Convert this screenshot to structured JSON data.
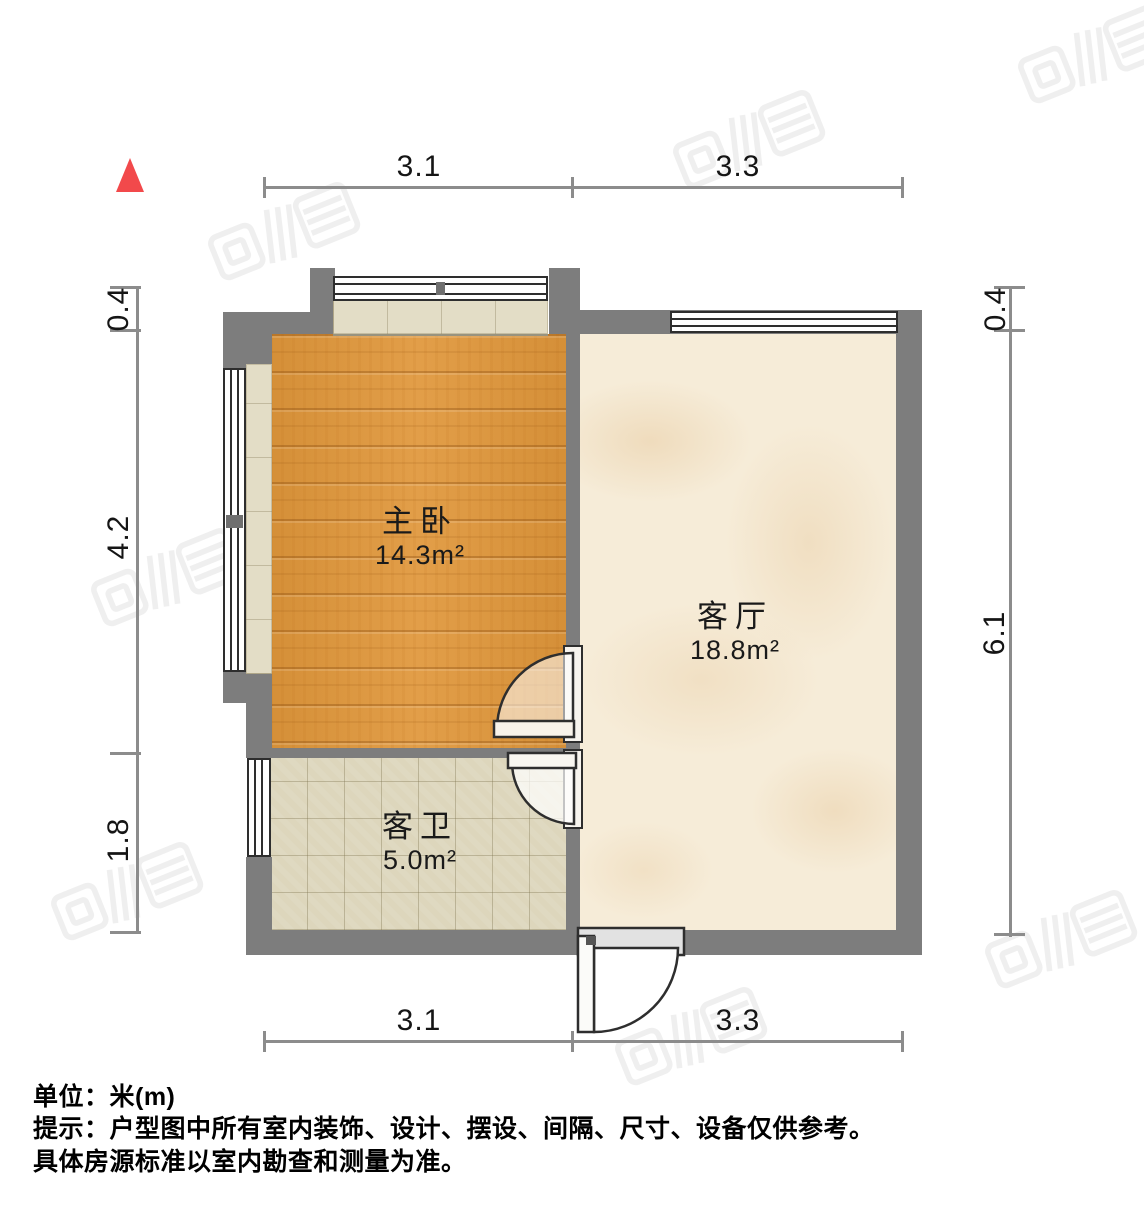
{
  "rooms": [
    {
      "name": "主卧",
      "area": "14.3m²"
    },
    {
      "name": "客厅",
      "area": "18.8m²"
    },
    {
      "name": "客卫",
      "area": "5.0m²"
    }
  ],
  "dimensions": {
    "top": [
      "3.1",
      "3.3"
    ],
    "bottom": [
      "3.1",
      "3.3"
    ],
    "left": [
      "0.4",
      "4.2",
      "1.8"
    ],
    "right": [
      "0.4",
      "6.1"
    ]
  },
  "footer": {
    "unit": "单位：米(m)",
    "note1": "提示：户型图中所有室内装饰、设计、摆设、间隔、尺寸、设备仅供参考。",
    "note2": "具体房源标准以室内勘查和测量为准。"
  },
  "colors": {
    "wall": "#7d7d7d",
    "dim": "#8c8c8c",
    "text": "#151515",
    "north": "#f2494b",
    "wood": "#e0973b",
    "marble": "#f6ecd8",
    "tile": "#ddd6bc",
    "sill": "#e3ddc6",
    "stroke": "#2e2e2e"
  },
  "watermarks": {
    "icon": "watermark-logo",
    "positions": [
      {
        "x": 750,
        "y": 140,
        "tone": "dark"
      },
      {
        "x": 1095,
        "y": 55,
        "tone": "dark"
      },
      {
        "x": 285,
        "y": 232,
        "tone": "dark"
      },
      {
        "x": 905,
        "y": 382,
        "tone": "light"
      },
      {
        "x": 532,
        "y": 487,
        "tone": "light"
      },
      {
        "x": 168,
        "y": 578,
        "tone": "dark"
      },
      {
        "x": 128,
        "y": 892,
        "tone": "dark"
      },
      {
        "x": 1062,
        "y": 940,
        "tone": "dark"
      },
      {
        "x": 692,
        "y": 1037,
        "tone": "dark"
      }
    ]
  }
}
